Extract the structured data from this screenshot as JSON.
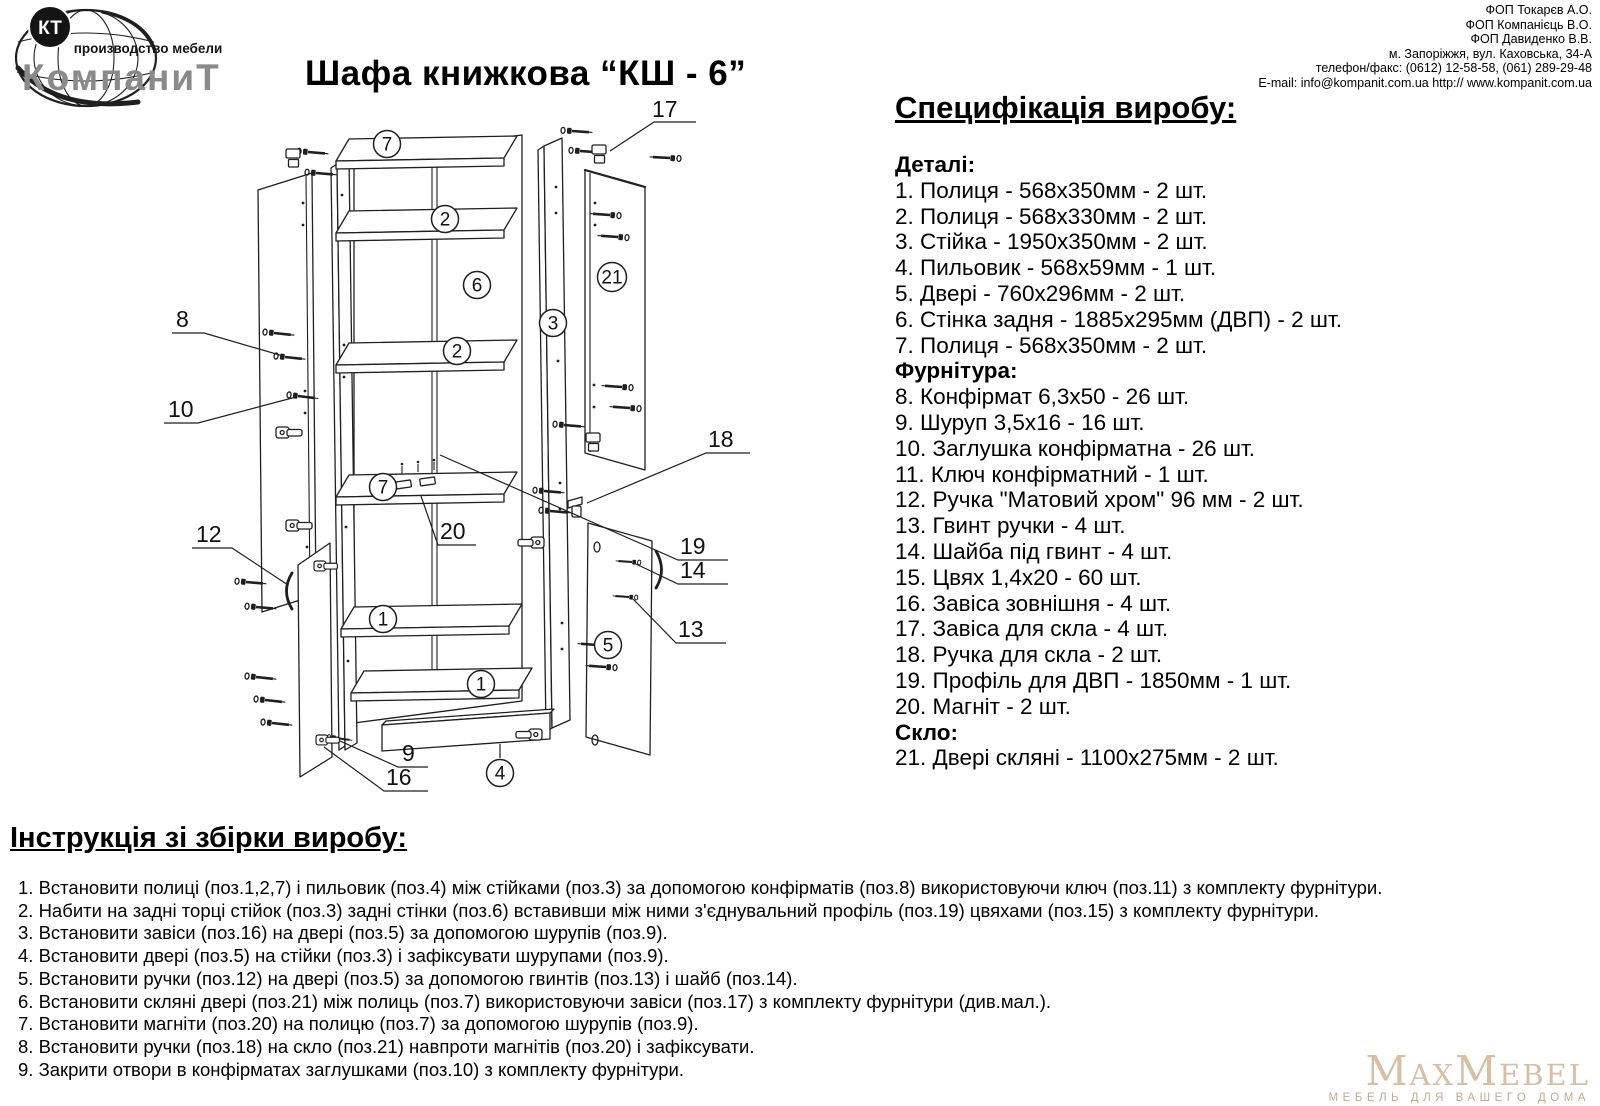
{
  "header": {
    "logo": {
      "monogram": "КТ",
      "tagline": "производство мебели",
      "brand": "КомпаниТ"
    },
    "title": "Шафа книжкова  “КШ - 6”",
    "contact_lines": [
      "ФОП Токарєв А.О.",
      "ФОП Компанієць В.О.",
      "ФОП Давиденко В.В.",
      "м. Запоріжжя, вул. Каховська, 34-А",
      "телефон/факс: (0612) 12-58-58,  (061) 289-29-48",
      "E-mail: info@kompanit.com.ua http:// www.kompanit.com.ua"
    ]
  },
  "spec": {
    "heading": "Специфікація виробу:",
    "sections": [
      {
        "title": "Деталі:",
        "items": [
          "1. Полиця - 568х350мм - 2 шт.",
          "2. Полиця - 568х330мм - 2 шт.",
          "3. Стійка - 1950х350мм - 2 шт.",
          "4. Пильовик - 568х59мм - 1 шт.",
          "5. Двері - 760х296мм - 2 шт.",
          "6. Стінка задня - 1885х295мм (ДВП) - 2 шт.",
          "7. Полиця - 568х350мм - 2 шт."
        ]
      },
      {
        "title": "Фурнітура:",
        "items": [
          "8. Конфірмат 6,3х50 - 26 шт.",
          "9. Шуруп 3,5х16 - 16 шт.",
          "10. Заглушка конфірматна - 26 шт.",
          "11. Ключ конфірматний - 1 шт.",
          "12. Ручка \"Матовий хром\" 96 мм - 2 шт.",
          "13. Гвинт ручки - 4 шт.",
          "14. Шайба під гвинт - 4 шт.",
          "15. Цвях 1,4х20 - 60 шт.",
          "16. Завіса зовнішня - 4 шт.",
          "17. Завіса для скла - 4 шт.",
          "18. Ручка для скла - 2 шт.",
          "19. Профіль для ДВП - 1850мм - 1 шт.",
          "20. Магніт - 2 шт."
        ]
      },
      {
        "title": "Скло:",
        "items": [
          "21. Двері скляні - 1100х275мм - 2 шт."
        ]
      }
    ]
  },
  "instructions": {
    "heading": "Інструкція зі збірки виробу:",
    "steps": [
      "1. Встановити полиці (поз.1,2,7) і пильовик (поз.4) між стійками (поз.3) за допомогою конфірматів (поз.8) використовуючи ключ (поз.11) з комплекту фурнітури.",
      "2. Набити на задні торці стійок (поз.3) задні стінки (поз.6) вставивши між ними з'єднувальний профіль (поз.19) цвяхами (поз.15) з комплекту фурнітури.",
      "3. Встановити завіси (поз.16) на двері (поз.5) за допомогою шурупів (поз.9).",
      "4. Встановити двері (поз.5) на стійки (поз.3) і зафіксувати шурупами (поз.9).",
      "5. Встановити ручки (поз.12) на двері (поз.5) за допомогою гвинтів (поз.13) і шайб (поз.14).",
      "6. Встановити скляні двері (поз.21) між полиць (поз.7) використовуючи завіси (поз.17) з комплекту фурнітури (див.мал.).",
      "7. Встановити магніти (поз.20) на полицю (поз.7) за допомогою шурупів (поз.9).",
      "8. Встановити ручки (поз.18) на скло (поз.21) навпроти магнітів (поз.20) і зафіксувати.",
      "9. Закрити отвори в конфірматах заглушками (поз.10) з комплекту фурнітури."
    ]
  },
  "diagram": {
    "circled": {
      "c7a": "7",
      "c2a": "2",
      "c6": "6",
      "c2b": "2",
      "c3": "3",
      "c21": "21",
      "c7b": "7",
      "c1a": "1",
      "c1b": "1",
      "c5": "5",
      "c4": "4"
    },
    "plain": {
      "n17": "17",
      "n8": "8",
      "n10": "10",
      "n18": "18",
      "n12": "12",
      "n20": "20",
      "n19": "19",
      "n14": "14",
      "n13": "13",
      "n9": "9",
      "n16": "16"
    }
  },
  "footer_logo": {
    "brand": "MaxMebel",
    "tagline": "МЕБЕЛЬ ДЛЯ ВАШЕГО ДОМА"
  },
  "colors": {
    "line": "#1f1f1f",
    "kompanit_gray": "#8a8a8a",
    "maxmebel_tan": "#d8bfa4",
    "maxmebel_tagline_tan": "#c9a98a"
  }
}
